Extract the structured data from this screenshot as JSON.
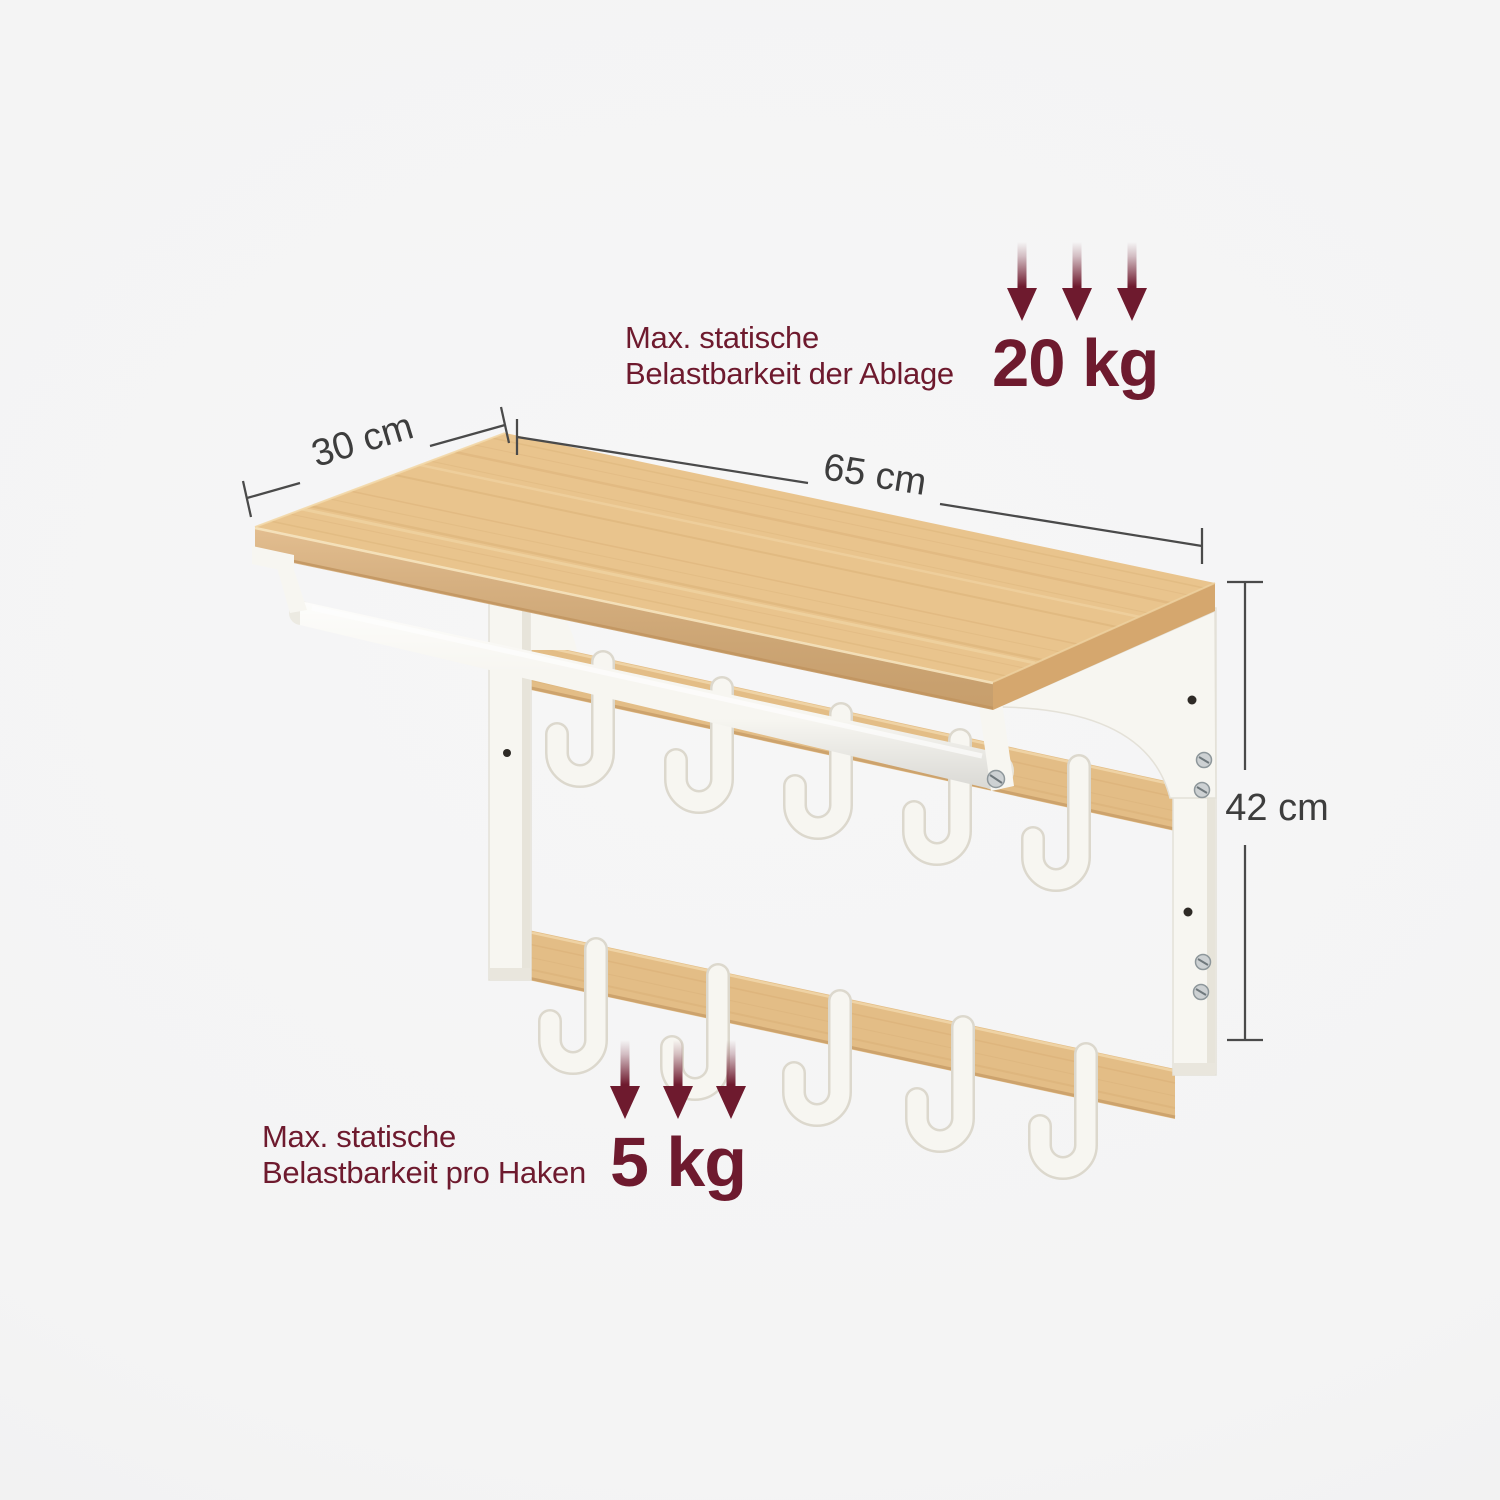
{
  "image_type": "product dimension illustration",
  "colors": {
    "background": "#f4f4f4",
    "maroon": "#6e1a2e",
    "dim_line": "#4a4a4a",
    "dim_text": "#3d3d3d",
    "wood_top": "#e9c48d",
    "wood_front": "#ddb078",
    "wood_side": "#d5a76e",
    "wood_slat": "#e3bd86",
    "wood_grain": "#cfa267",
    "metal": "#f7f6f1",
    "metal_shade": "#dcd8cd",
    "screw": "#cdd1d3",
    "hole": "#2e2a26"
  },
  "dimensions": {
    "depth_label": "30 cm",
    "width_label": "65 cm",
    "height_label": "42 cm"
  },
  "annotations": {
    "shelf_load": {
      "line1": "Max. statische",
      "line2": "Belastbarkeit der Ablage",
      "value": "20 kg"
    },
    "hook_load": {
      "line1": "Max. statische",
      "line2": "Belastbarkeit pro Haken",
      "value": "5 kg"
    }
  },
  "product": {
    "upper_hook_count": 5,
    "lower_hook_count": 5
  }
}
